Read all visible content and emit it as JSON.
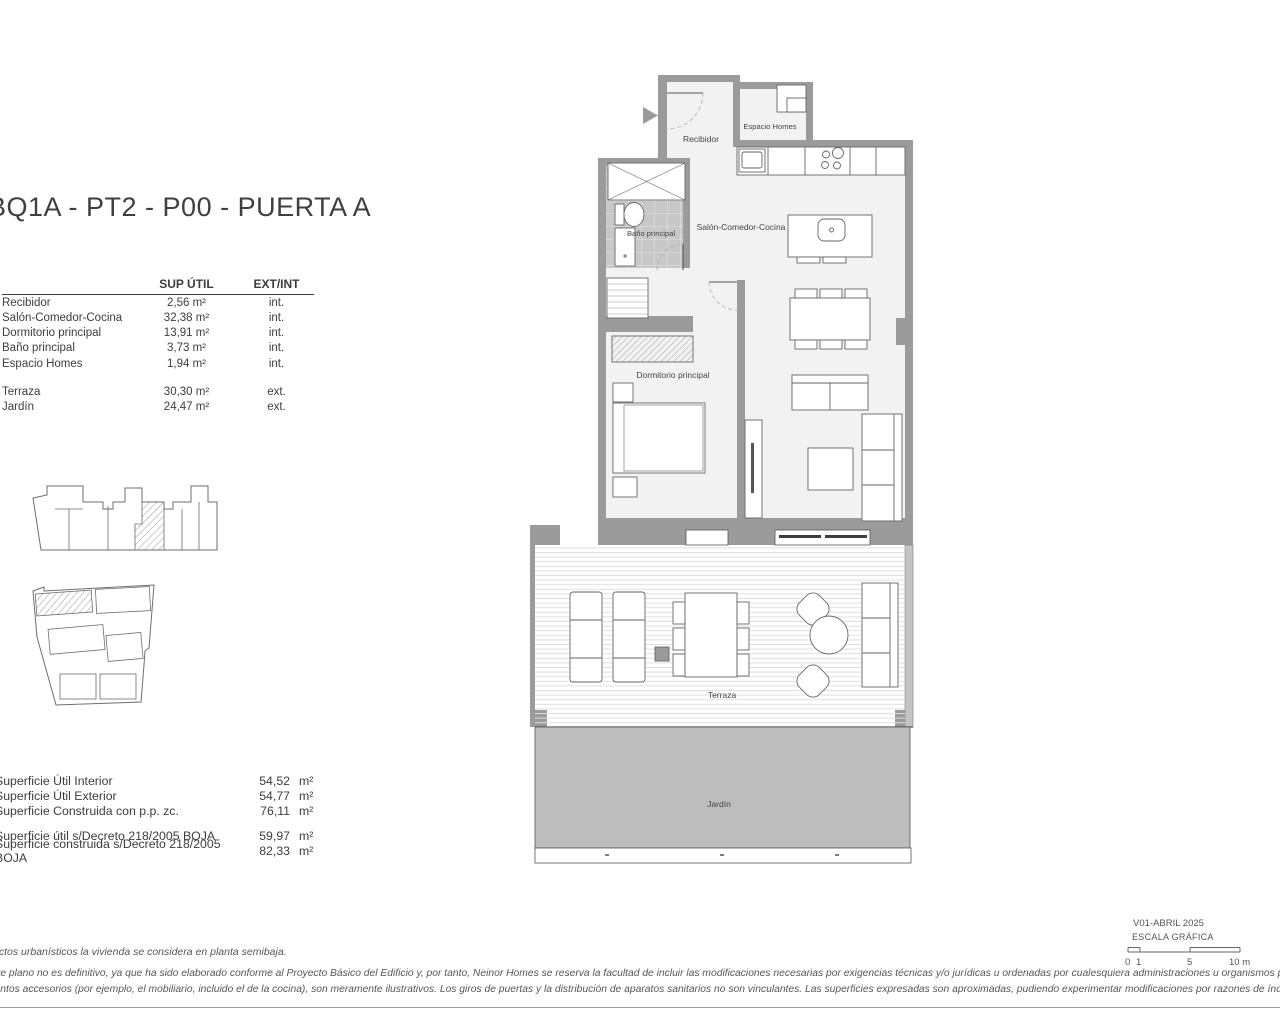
{
  "header": {
    "title": "BQ1A - PT2 - P00 -  PUERTA A"
  },
  "room_table": {
    "col_sup": "SUP ÚTIL",
    "col_ext": "EXT/INT",
    "rows": [
      {
        "name": "Recibidor",
        "sup": "2,56 m²",
        "ext": "int."
      },
      {
        "name": "Salón-Comedor-Cocina",
        "sup": "32,38 m²",
        "ext": "int."
      },
      {
        "name": "Dormitorio principal",
        "sup": "13,91 m²",
        "ext": "int."
      },
      {
        "name": "Baño principal",
        "sup": "3,73 m²",
        "ext": "int."
      },
      {
        "name": "Espacio Homes",
        "sup": "1,94 m²",
        "ext": "int."
      },
      {
        "name": "Terraza",
        "sup": "30,30 m²",
        "ext": "ext."
      },
      {
        "name": "Jardín",
        "sup": "24,47 m²",
        "ext": "ext."
      }
    ]
  },
  "summary": {
    "rows": [
      {
        "label": "Superficie Útil Interior",
        "value": "54,52",
        "unit": "m²"
      },
      {
        "label": "Superficie Útil Exterior",
        "value": "54,77",
        "unit": "m²"
      },
      {
        "label": "Superficie Construida con p.p. zc.",
        "value": "76,11",
        "unit": "m²"
      },
      {
        "label": "Superficie útil s/Decreto 218/2005 BOJA",
        "value": "59,97",
        "unit": "m²"
      },
      {
        "label": "Superficie construida s/Decreto 218/2005 BOJA",
        "value": "82,33",
        "unit": "m²"
      }
    ]
  },
  "plan": {
    "rooms": {
      "recibidor": "Recibidor",
      "espacio_homes": "Espacio Homes",
      "salon": "Salón-Comedor-Cocina",
      "bano": "Baño principal",
      "dormitorio": "Dormitorio principal",
      "terraza": "Terraza",
      "jardin": "Jardín"
    }
  },
  "scale": {
    "version": "V01-ABRIL 2025",
    "label": "ESCALA GRÁFICA",
    "t0": "0",
    "t1": "1",
    "t5": "5",
    "t10": "10 m"
  },
  "notes": {
    "note1": "ectos urbanísticos la vivienda se considera en planta semibaja.",
    "disclaimer1": "ente plano no es definitivo, ya que ha sido elaborado conforme al Proyecto Básico del Edificio y, por tanto, Neinor Homes se reserva la facultad de incluir las modificaciones necesarias por exigencias técnicas y/o jurídicas u ordenadas por cualesquiera administraciones u organismos públicos, ajustándolo en todo caso al Proyecto de Ejecución",
    "disclaimer2": "mentos accesorios (por ejemplo, el mobiliario, incluido el de la cocina), son meramente ilustrativos. Los giros de puertas y la distribución de aparatos sanitarios no son vinculantes. Las superficies expresadas son aproximadas, pudiendo experimentar modificaciones por razones de índole técnicas y/o legal en el desarrollo de la ejecución de la"
  },
  "colors": {
    "wall": "#9b9b9b",
    "tile": "#c8c8c8",
    "garden": "#bdbdbd",
    "line": "#555555"
  }
}
